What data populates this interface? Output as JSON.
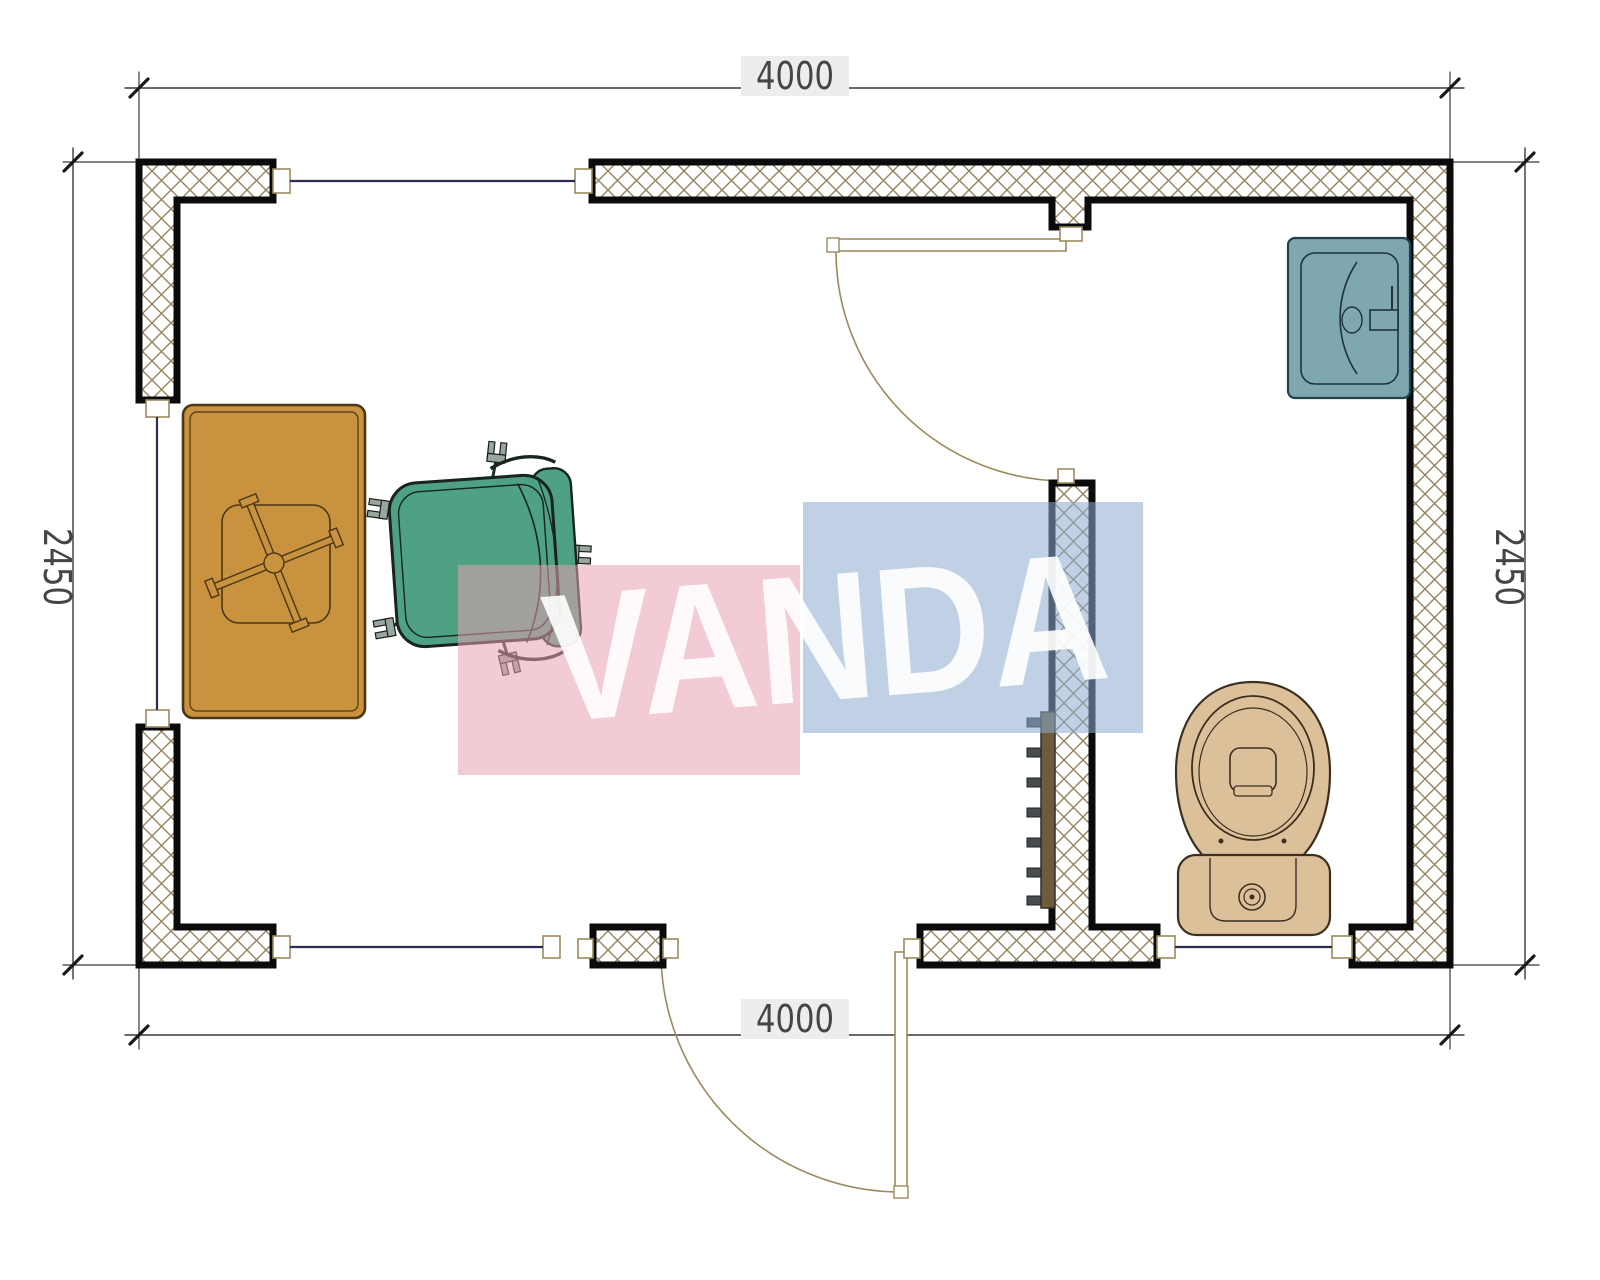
{
  "drawing": {
    "type": "architectural floor plan, top view",
    "unit_hint": "millimetres"
  },
  "dimensions": {
    "top": "4000",
    "bottom": "4000",
    "left": "2450",
    "right": "2450"
  },
  "watermark": {
    "text": "VANDA"
  },
  "fixtures": {
    "desk": "desk with cross base",
    "chair": "office swivel chair",
    "sink": "washbasin",
    "toilet": "toilet",
    "radiator": "towel radiator",
    "doors": "2 swing doors",
    "windows": "4 windows"
  },
  "colors": {
    "wall_hatch": "#93845f",
    "wall_outline": "#0b0b0b",
    "window_line": "#2a2f52",
    "door_line": "#9b8a5c",
    "dim_line": "#3a3a3a",
    "dim_text": "#454545",
    "desk": "#c8923e",
    "desk_outline": "#4a3715",
    "chair": "#4fa183",
    "chair_outline": "#182420",
    "caster": "#97a79b",
    "sink": "#7fa7b0",
    "sink_outline": "#21424c",
    "toilet": "#dcc09a",
    "toilet_outline": "#3c2f1f",
    "radiator": "#6d5b3b",
    "radiator_tab": "#474c4f",
    "watermark_pink": "rgba(231,160,176,0.55)",
    "watermark_blue": "rgba(141,171,208,0.55)",
    "watermark_text": "rgba(255,255,255,0.9)"
  }
}
